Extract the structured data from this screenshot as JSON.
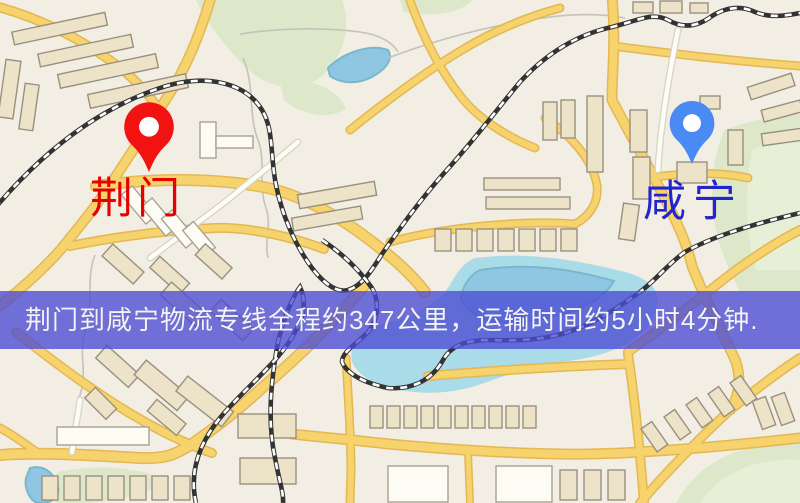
{
  "banner": {
    "text": "荆门到咸宁物流专线全程约347公里，运输时间约5小时4分钟.",
    "bg_color": "rgba(76,76,212,0.78)",
    "text_color": "#f4f4f4"
  },
  "markers": {
    "origin": {
      "label": "荆门",
      "label_color": "#e60000",
      "pin_color": "#f21212",
      "pin_hole_color": "#ffffff",
      "icon": "map-pin-icon"
    },
    "destination": {
      "label": "咸宁",
      "label_color": "#2424cd",
      "pin_color": "#4a8af4",
      "pin_hole_color": "#ffffff",
      "icon": "map-pin-icon"
    }
  },
  "map_palette": {
    "land": "#f2eee3",
    "road": "#f6d36d",
    "road_casing": "#e3b754",
    "park": "#dde8ca",
    "park2": "#e7efd6",
    "water": "#8fc6e2",
    "water2": "#a9dce8",
    "water_edge": "#79b8cc",
    "building": "#ece3c9",
    "building_stroke": "#9a907e",
    "railway": "#333333"
  }
}
